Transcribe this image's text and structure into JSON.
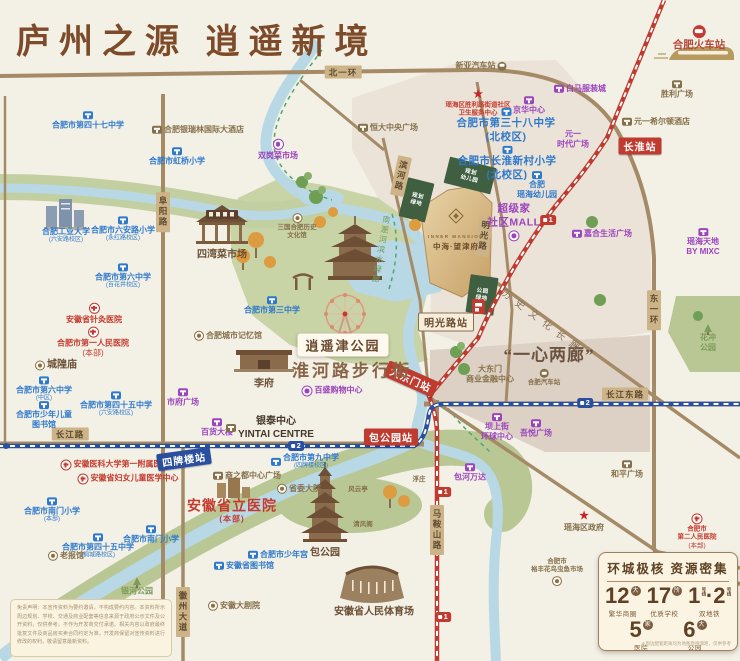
{
  "title": "庐州之源  逍遥新境",
  "project": {
    "name_en": "INNER MANSION",
    "name_cn": "中海·望津府"
  },
  "stats": {
    "title": "环城极核  资源密集",
    "items": [
      {
        "num": "12",
        "unit": "大",
        "label": "繁华商圈"
      },
      {
        "num": "17",
        "unit": "所",
        "label": "优质学校"
      },
      {
        "num": "1·2",
        "unit": "号线",
        "label": "双地铁",
        "vertical_unit": true
      },
      {
        "num": "5",
        "unit": "家",
        "label": "医院"
      },
      {
        "num": "6",
        "unit": "大",
        "label": "公园"
      }
    ],
    "footnote": "＊周边配套距离均为地图直线测距，仅供参考"
  },
  "disclaimer": "免责声明：本宣传资料为要约邀请，不构成要约内容。本资料所示周边规划、学校、交通及商业配套等信息来源于政府公示文件及公开资料，仅供参考，不作为开发商交付承诺。相关内容以政府最终批复文件及商品房买卖合同约定为准，开发商保留对宣传资料进行修改的权利，敬请留意最新资料。",
  "map": {
    "road_labels": [
      {
        "text": "北一环",
        "x": 343,
        "y": 72,
        "mode": "h"
      },
      {
        "text": "长江路",
        "x": 70,
        "y": 434,
        "mode": "h"
      },
      {
        "text": "长江东路",
        "x": 625,
        "y": 394,
        "mode": "h"
      },
      {
        "text": "阜阳路",
        "x": 163,
        "y": 212,
        "mode": "v"
      },
      {
        "text": "东一环",
        "x": 654,
        "y": 310,
        "mode": "v"
      },
      {
        "text": "马鞍山路",
        "x": 437,
        "y": 530,
        "mode": "v"
      },
      {
        "text": "徽州大道",
        "x": 183,
        "y": 612,
        "mode": "v"
      },
      {
        "text": "滨河路",
        "x": 401,
        "y": 176,
        "mode": "v",
        "rot": 12
      },
      {
        "text": "明光路",
        "x": 484,
        "y": 236,
        "mode": "v",
        "rot": 8
      }
    ],
    "stations": [
      {
        "text": "长淮站",
        "x": 640,
        "y": 146,
        "color": "red"
      },
      {
        "text": "明光路站",
        "x": 446,
        "y": 322,
        "color": "cream"
      },
      {
        "text": "大东门站",
        "x": 411,
        "y": 379,
        "color": "red",
        "rot": 24
      },
      {
        "text": "包公园站",
        "x": 391,
        "y": 437,
        "color": "red"
      },
      {
        "text": "四牌楼站",
        "x": 184,
        "y": 459,
        "color": "blue",
        "rot": -8
      }
    ],
    "metro_icons": [
      {
        "line": "1",
        "x": 548,
        "y": 220
      },
      {
        "line": "1",
        "x": 443,
        "y": 492
      },
      {
        "line": "1",
        "x": 443,
        "y": 617
      },
      {
        "line": "2",
        "x": 296,
        "y": 446
      },
      {
        "line": "2",
        "x": 585,
        "y": 403
      }
    ],
    "big_labels": [
      {
        "text": "逍遥津公园",
        "x": 343,
        "y": 345,
        "cls": "bl-parkbox"
      },
      {
        "text": "淮河路步行街",
        "x": 352,
        "y": 369,
        "cls": "bl-street"
      },
      {
        "text": "“一心两廊”",
        "x": 549,
        "y": 353,
        "cls": "bl-quote"
      },
      {
        "text": "历史文化长廊",
        "x": 544,
        "y": 321,
        "cls": "bl-corridor",
        "rot": 37
      },
      {
        "text": "南淝河滨水绿廊",
        "x": 381,
        "y": 250,
        "cls": "bl-river",
        "rot": 10
      }
    ],
    "pois": [
      {
        "lines": [
          "合肥市第四十七中学"
        ],
        "x": 88,
        "y": 121,
        "cls": "school",
        "icon": "school",
        "ipos": "above"
      },
      {
        "lines": [
          "合肥市虹桥小学"
        ],
        "x": 177,
        "y": 157,
        "cls": "school",
        "icon": "school",
        "ipos": "above"
      },
      {
        "lines": [
          "合肥工业大学",
          "(六安路校区)"
        ],
        "x": 66,
        "y": 236,
        "cls": "school"
      },
      {
        "lines": [
          "合肥市六安路小学",
          "(永红路校区)"
        ],
        "x": 123,
        "y": 230,
        "cls": "school",
        "icon": "school",
        "ipos": "above"
      },
      {
        "lines": [
          "合肥市第六中学",
          "(百花井校区)"
        ],
        "x": 123,
        "y": 277,
        "cls": "school",
        "icon": "school",
        "ipos": "above"
      },
      {
        "lines": [
          "合肥市第三中学"
        ],
        "x": 272,
        "y": 306,
        "cls": "school",
        "icon": "school",
        "ipos": "above"
      },
      {
        "lines": [
          "合肥市第六中学",
          "(中区)"
        ],
        "x": 44,
        "y": 390,
        "cls": "school",
        "icon": "school",
        "ipos": "above"
      },
      {
        "lines": [
          "合肥市少年儿童",
          "图书馆"
        ],
        "x": 44,
        "y": 416,
        "cls": "school",
        "icon": "school",
        "ipos": "above"
      },
      {
        "lines": [
          "合肥市第四十五中学",
          "(六安路校区)"
        ],
        "x": 116,
        "y": 405,
        "cls": "school",
        "icon": "school",
        "ipos": "above"
      },
      {
        "lines": [
          "合肥市南门小学",
          "(本部)"
        ],
        "x": 52,
        "y": 511,
        "cls": "school",
        "icon": "school",
        "ipos": "above"
      },
      {
        "lines": [
          "合肥市第四十五中学",
          "(桐城路校区)"
        ],
        "x": 98,
        "y": 547,
        "cls": "school",
        "icon": "school",
        "ipos": "above"
      },
      {
        "lines": [
          "合肥市南门小学"
        ],
        "x": 151,
        "y": 535,
        "cls": "school",
        "icon": "school",
        "ipos": "above"
      },
      {
        "lines": [
          "合肥市第九中学",
          "(四牌楼校区)"
        ],
        "x": 305,
        "y": 462,
        "cls": "school",
        "icon": "school",
        "ipos": "left"
      },
      {
        "lines": [
          "合肥市少年宫"
        ],
        "x": 278,
        "y": 555,
        "cls": "school",
        "icon": "school",
        "ipos": "left"
      },
      {
        "lines": [
          "安徽省图书馆"
        ],
        "x": 244,
        "y": 566,
        "cls": "school",
        "icon": "school",
        "ipos": "left"
      },
      {
        "lines": [
          "合肥市第三十八中学",
          "(北校区)"
        ],
        "x": 506,
        "y": 126,
        "cls": "school bigf",
        "icon": "school",
        "ipos": "above"
      },
      {
        "lines": [
          "合肥市长淮新村小学",
          "(北校区)"
        ],
        "x": 507,
        "y": 164,
        "cls": "school bigf",
        "icon": "school",
        "ipos": "above"
      },
      {
        "lines": [
          "合肥",
          "瑶海幼儿园"
        ],
        "x": 537,
        "y": 186,
        "cls": "school",
        "icon": "school",
        "ipos": "above"
      },
      {
        "lines": [
          "双岗菜市场"
        ],
        "x": 278,
        "y": 150,
        "cls": "mall small",
        "icon": "circle",
        "ipos": "above"
      },
      {
        "lines": [
          "白马服装城"
        ],
        "x": 580,
        "y": 89,
        "cls": "mall",
        "icon": "mall",
        "ipos": "left"
      },
      {
        "lines": [
          "京华中心"
        ],
        "x": 529,
        "y": 106,
        "cls": "mall",
        "icon": "mall",
        "ipos": "above"
      },
      {
        "lines": [
          "元一",
          "时代广场"
        ],
        "x": 573,
        "y": 140,
        "cls": "mall"
      },
      {
        "lines": [
          "超级家",
          "社区MALL"
        ],
        "x": 514,
        "y": 222,
        "cls": "mall bigf",
        "icon": "circle",
        "ipos": "below"
      },
      {
        "lines": [
          "嘉合生活广场"
        ],
        "x": 602,
        "y": 234,
        "cls": "mall",
        "icon": "mall",
        "ipos": "left"
      },
      {
        "lines": [
          "瑶海天地",
          "BY MIXC"
        ],
        "x": 703,
        "y": 243,
        "cls": "mall small",
        "icon": "mall",
        "ipos": "above"
      },
      {
        "lines": [
          "市府广场"
        ],
        "x": 183,
        "y": 398,
        "cls": "mall",
        "icon": "mall",
        "ipos": "above"
      },
      {
        "lines": [
          "百货大楼"
        ],
        "x": 217,
        "y": 428,
        "cls": "mall",
        "icon": "mall",
        "ipos": "above"
      },
      {
        "lines": [
          "百盛购物中心"
        ],
        "x": 332,
        "y": 391,
        "cls": "mall",
        "icon": "circle",
        "ipos": "left"
      },
      {
        "lines": [
          "坝上街",
          "环球中心"
        ],
        "x": 497,
        "y": 428,
        "cls": "mall",
        "icon": "mall",
        "ipos": "above"
      },
      {
        "lines": [
          "吾悦广场"
        ],
        "x": 536,
        "y": 429,
        "cls": "mall",
        "icon": "mall",
        "ipos": "above"
      },
      {
        "lines": [
          "包河万达"
        ],
        "x": 470,
        "y": 473,
        "cls": "mall",
        "icon": "mall",
        "ipos": "above"
      },
      {
        "lines": [
          "合肥银瑞林国际大酒店"
        ],
        "x": 198,
        "y": 130,
        "cls": "biz",
        "icon": "biz",
        "ipos": "left"
      },
      {
        "lines": [
          "恒大中央广场"
        ],
        "x": 388,
        "y": 128,
        "cls": "biz",
        "icon": "biz",
        "ipos": "left"
      },
      {
        "lines": [
          "新亚汽车站"
        ],
        "x": 481,
        "y": 66,
        "cls": "biz",
        "icon": "bus",
        "ipos": "right"
      },
      {
        "lines": [
          "元一希尔顿酒店"
        ],
        "x": 656,
        "y": 122,
        "cls": "biz",
        "icon": "biz",
        "ipos": "left"
      },
      {
        "lines": [
          "胜利广场"
        ],
        "x": 677,
        "y": 90,
        "cls": "biz small",
        "icon": "biz",
        "ipos": "above"
      },
      {
        "lines": [
          "合肥火车站"
        ],
        "x": 699,
        "y": 39,
        "cls": "trainred",
        "icon": "rail",
        "ipos": "above"
      },
      {
        "lines": [
          "三国合肥历史",
          "文化馆"
        ],
        "x": 297,
        "y": 227,
        "cls": "biz tiny",
        "icon": "dot",
        "ipos": "above"
      },
      {
        "lines": [
          "四湾菜市场"
        ],
        "x": 222,
        "y": 255,
        "cls": "brown"
      },
      {
        "lines": [
          "合肥城市记忆馆"
        ],
        "x": 228,
        "y": 336,
        "cls": "biz",
        "icon": "dot",
        "ipos": "left"
      },
      {
        "lines": [
          "李府"
        ],
        "x": 264,
        "y": 384,
        "cls": "brown"
      },
      {
        "lines": [
          "城隍庙"
        ],
        "x": 56,
        "y": 365,
        "cls": "brown",
        "icon": "dot",
        "ipos": "left"
      },
      {
        "lines": [
          "银泰中心",
          "YINTAI CENTRE"
        ],
        "x": 270,
        "y": 428,
        "cls": "dark",
        "icon": "biz",
        "ipos": "left"
      },
      {
        "lines": [
          "老报馆"
        ],
        "x": 66,
        "y": 556,
        "cls": "biz",
        "icon": "dot",
        "ipos": "left"
      },
      {
        "lines": [
          "商之都中心广场"
        ],
        "x": 247,
        "y": 476,
        "cls": "biz",
        "icon": "biz",
        "ipos": "left"
      },
      {
        "lines": [
          "省委大院"
        ],
        "x": 299,
        "y": 489,
        "cls": "biz",
        "icon": "dot",
        "ipos": "left"
      },
      {
        "lines": [
          "安徽大剧院"
        ],
        "x": 234,
        "y": 606,
        "cls": "biz small",
        "icon": "dot",
        "ipos": "left"
      },
      {
        "lines": [
          "安徽省人民体育场"
        ],
        "x": 374,
        "y": 612,
        "cls": "brown"
      },
      {
        "lines": [
          "大东门",
          "商业金融中心"
        ],
        "x": 490,
        "y": 375,
        "cls": "biz"
      },
      {
        "lines": [
          "合肥汽车站"
        ],
        "x": 544,
        "y": 378,
        "cls": "biz tiny",
        "icon": "bus",
        "ipos": "above"
      },
      {
        "lines": [
          "和平广场"
        ],
        "x": 627,
        "y": 470,
        "cls": "biz",
        "icon": "biz",
        "ipos": "above"
      },
      {
        "lines": [
          "瑶海区政府"
        ],
        "x": 584,
        "y": 522,
        "cls": "biz",
        "icon": "star",
        "ipos": "above"
      },
      {
        "lines": [
          "合肥市",
          "裕丰花鸟虫鱼市场"
        ],
        "x": 557,
        "y": 572,
        "cls": "biz tiny",
        "icon": "dot",
        "ipos": "below"
      },
      {
        "lines": [
          "浮庄"
        ],
        "x": 419,
        "y": 480,
        "cls": "biz tiny"
      },
      {
        "lines": [
          "风云亭"
        ],
        "x": 358,
        "y": 490,
        "cls": "biz tiny"
      },
      {
        "lines": [
          "清风阁"
        ],
        "x": 363,
        "y": 525,
        "cls": "biz tiny"
      },
      {
        "lines": [
          "包公园"
        ],
        "x": 325,
        "y": 553,
        "cls": "brown"
      },
      {
        "lines": [
          "安徽省针灸医院"
        ],
        "x": 94,
        "y": 314,
        "cls": "hosp small",
        "icon": "hosp",
        "ipos": "above"
      },
      {
        "lines": [
          "合肥市第一人民医院",
          "(本部)"
        ],
        "x": 93,
        "y": 343,
        "cls": "hosp small",
        "icon": "hosp",
        "ipos": "above"
      },
      {
        "lines": [
          "安徽医科大学第一附属医院"
        ],
        "x": 115,
        "y": 465,
        "cls": "hosp small",
        "icon": "hosp",
        "ipos": "left"
      },
      {
        "lines": [
          "安徽省妇女儿童医学中心"
        ],
        "x": 128,
        "y": 479,
        "cls": "hosp small",
        "icon": "hosp",
        "ipos": "left"
      },
      {
        "lines": [
          "安徽省立医院",
          "(本部)"
        ],
        "x": 232,
        "y": 511,
        "cls": "redbig"
      },
      {
        "lines": [
          "合肥市",
          "第二人民医院",
          "(本部)"
        ],
        "x": 697,
        "y": 532,
        "cls": "hosp tiny",
        "icon": "hosp",
        "ipos": "above"
      },
      {
        "lines": [
          "瑶海区胜利路街道社区",
          "卫生服务中心"
        ],
        "x": 478,
        "y": 104,
        "cls": "hosp tiny",
        "icon": "star",
        "ipos": "above"
      },
      {
        "lines": [
          "花冲",
          "公园"
        ],
        "x": 708,
        "y": 339,
        "cls": "green",
        "icon": "pine",
        "ipos": "above"
      },
      {
        "lines": [
          "银河公园"
        ],
        "x": 137,
        "y": 587,
        "cls": "green",
        "icon": "pine",
        "ipos": "above"
      },
      {
        "lines": [
          "规划",
          "幼儿园"
        ],
        "x": 470,
        "y": 176,
        "cls": "gblock",
        "rot": 14
      },
      {
        "lines": [
          "规划",
          "绿地"
        ],
        "x": 417,
        "y": 200,
        "cls": "gblock",
        "rot": 14
      },
      {
        "lines": [
          "公园",
          "绿地"
        ],
        "x": 482,
        "y": 295,
        "cls": "gblock",
        "rot": 8
      },
      {
        "lines": [
          "INNER MANSION"
        ],
        "x": 456,
        "y": 237,
        "cls": "projen",
        "name": "project-name-en"
      },
      {
        "lines": [
          "中海·望津府"
        ],
        "x": 456,
        "y": 247,
        "cls": "projcn",
        "name": "project-name-cn"
      }
    ]
  }
}
